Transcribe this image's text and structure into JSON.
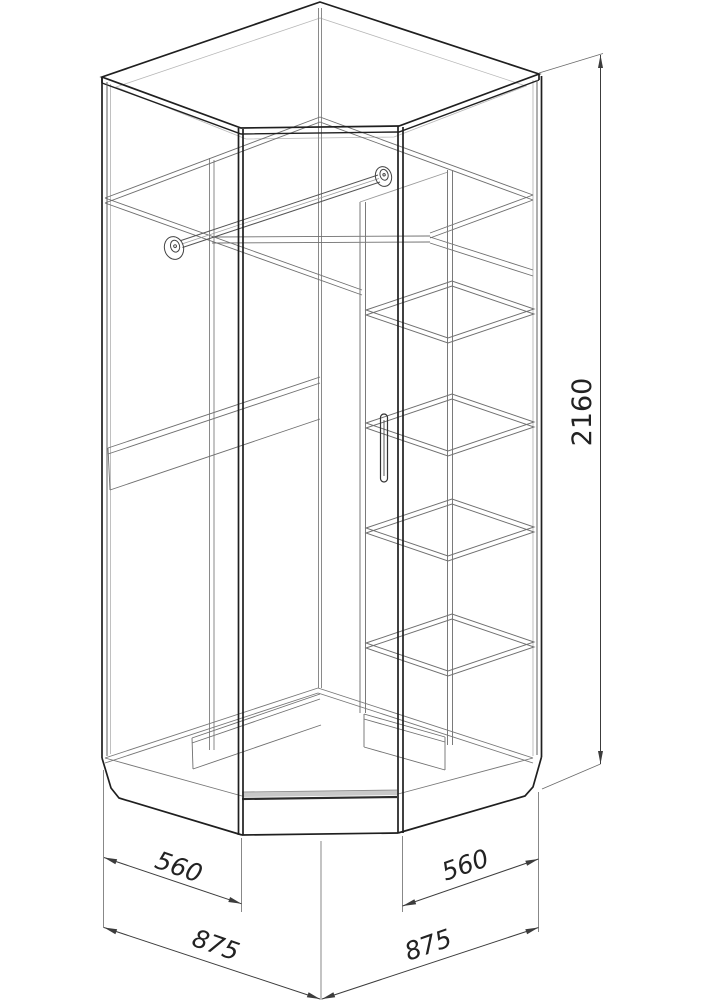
{
  "diagram": {
    "dimensions": {
      "height": "2160",
      "depth_left": "560",
      "depth_right": "560",
      "width_left": "875",
      "width_right": "875"
    },
    "colors": {
      "line_dark": "#1f1f1f",
      "line_medium": "#5f5f5f",
      "line_light": "#949494",
      "dimension_line": "#3c3c3c",
      "background": "#ffffff"
    }
  }
}
